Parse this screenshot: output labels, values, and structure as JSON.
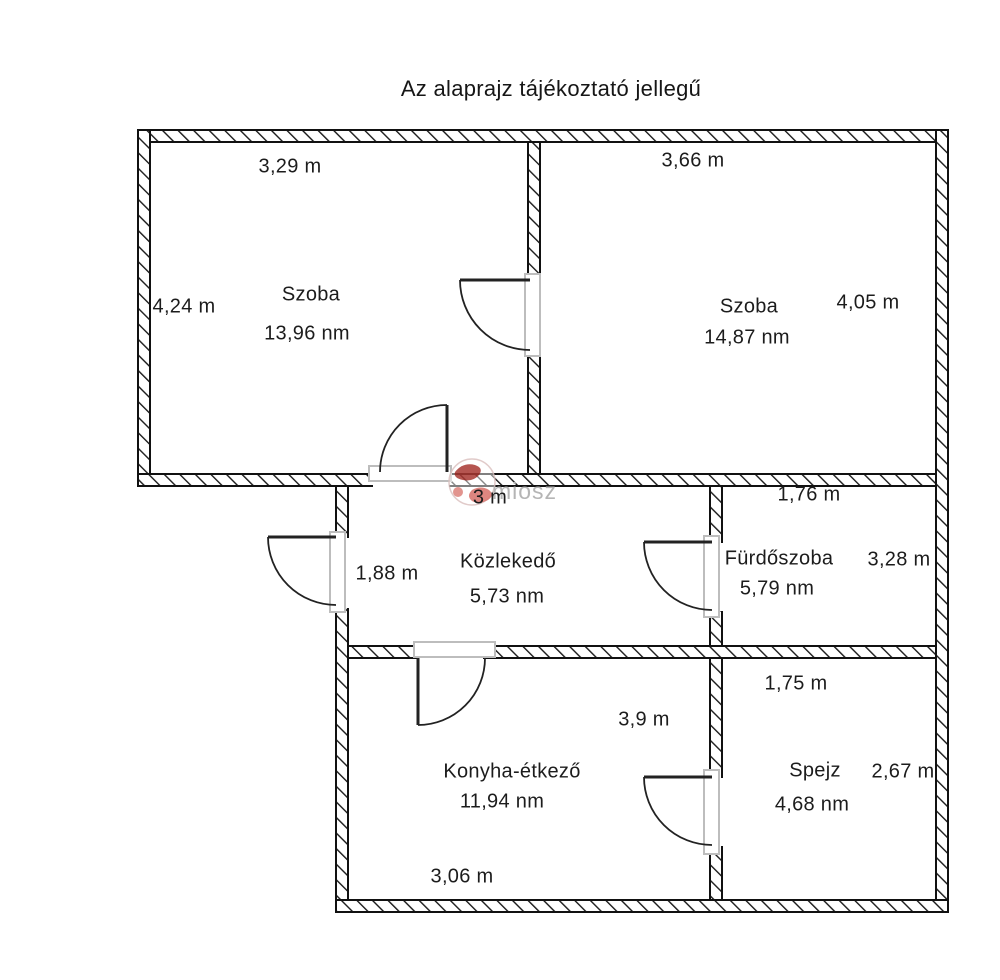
{
  "title": "Az alaprajz tájékoztató jellegű",
  "watermark": {
    "text": "miosz"
  },
  "colors": {
    "wall_line": "#1a1a1a",
    "door_frame": "#bdbdbd",
    "watermark_text": "#b5b5b5",
    "watermark_logo_dark": "#a93832",
    "watermark_logo_light": "#d4625a",
    "text": "#1c1c1c"
  },
  "rooms": [
    {
      "name": "Szoba",
      "area": "13,96 nm",
      "dim_top": "3,29 m",
      "dim_left": "4,24 m"
    },
    {
      "name": "Szoba",
      "area": "14,87 nm",
      "dim_top": "3,66 m",
      "dim_right": "4,05 m"
    },
    {
      "name": "Közlekedő",
      "area": "5,73 nm",
      "dim_top": "3 m",
      "dim_left": "1,88 m"
    },
    {
      "name": "Fürdőszoba",
      "area": "5,79 nm",
      "dim_top": "1,76 m",
      "dim_right": "3,28 m"
    },
    {
      "name": "Konyha-étkező",
      "area": "11,94 nm",
      "dim_right": "3,9 m",
      "dim_bottom": "3,06 m"
    },
    {
      "name": "Spejz",
      "area": "4,68 nm",
      "dim_top": "1,75 m",
      "dim_right": "2,67 m"
    }
  ]
}
